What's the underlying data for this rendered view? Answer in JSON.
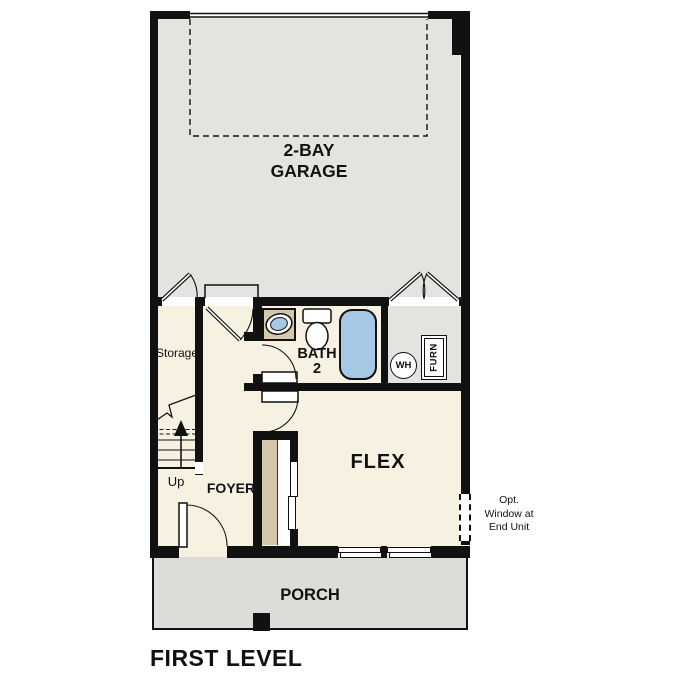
{
  "title": "FIRST LEVEL",
  "rooms": {
    "garage": {
      "label": "2-BAY\nGARAGE"
    },
    "storage": {
      "label": "Storage"
    },
    "bath": {
      "label": "BATH\n2"
    },
    "flex": {
      "label": "FLEX"
    },
    "foyer": {
      "label": "FOYER"
    },
    "porch": {
      "label": "PORCH"
    },
    "stairs": {
      "label": "Up"
    }
  },
  "fixtures": {
    "water_heater": {
      "label": "WH"
    },
    "furnace": {
      "label": "FURN"
    }
  },
  "annotations": {
    "opt_window": {
      "label": "Opt.\nWindow at\nEnd Unit"
    }
  },
  "colors": {
    "wall": "#111111",
    "floor_interior": "#f7f1e2",
    "floor_garage": "#e3e3e0",
    "floor_porch": "#dcdcd9",
    "casework_tan": "#d5c7a9",
    "fixture_blue": "#a6c8e5"
  }
}
